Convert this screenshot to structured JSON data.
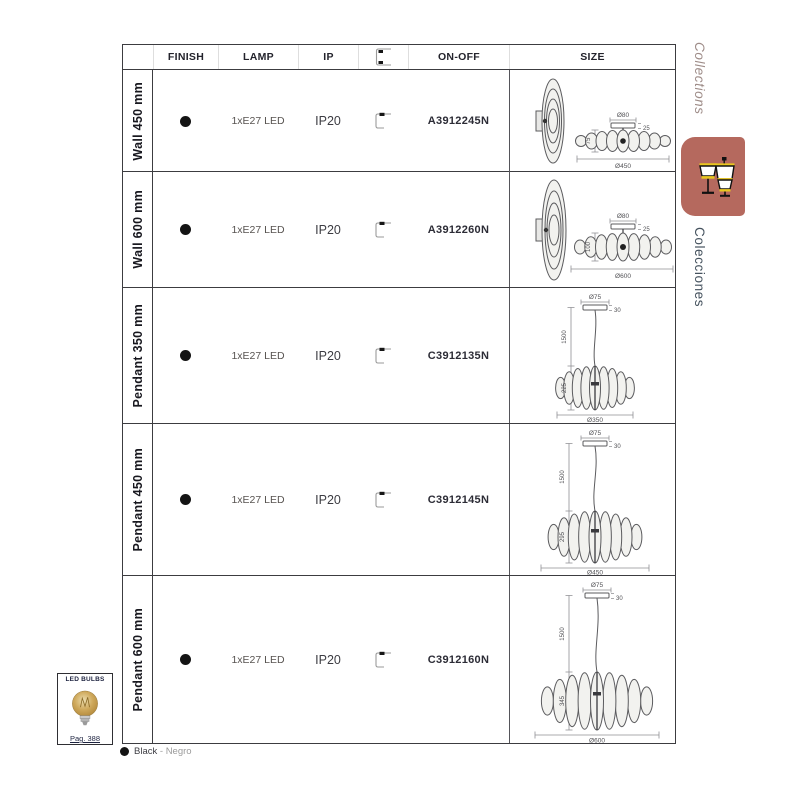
{
  "header": {
    "finish": "FINISH",
    "lamp": "LAMP",
    "ip": "IP",
    "on_off": "ON-OFF",
    "size": "SIZE"
  },
  "rows": [
    {
      "label": "Wall 450 mm",
      "lamp": "1xE27 LED",
      "ip": "IP20",
      "code": "A3912245N",
      "size": {
        "canopy_dia": "Ø80",
        "canopy_h": "25",
        "body_h": "75",
        "dia": "Ø450"
      }
    },
    {
      "label": "Wall 600 mm",
      "lamp": "1xE27 LED",
      "ip": "IP20",
      "code": "A3912260N",
      "size": {
        "canopy_dia": "Ø80",
        "canopy_h": "25",
        "body_h": "100",
        "dia": "Ø600"
      }
    },
    {
      "label": "Pendant 350 mm",
      "lamp": "1xE27 LED",
      "ip": "IP20",
      "code": "C3912135N",
      "size": {
        "canopy_dia": "Ø75",
        "canopy_h": "30",
        "drop": "1500",
        "body_h": "225",
        "dia": "Ø350"
      }
    },
    {
      "label": "Pendant 450 mm",
      "lamp": "1xE27 LED",
      "ip": "IP20",
      "code": "C3912145N",
      "size": {
        "canopy_dia": "Ø75",
        "canopy_h": "30",
        "drop": "1500",
        "body_h": "295",
        "dia": "Ø450"
      }
    },
    {
      "label": "Pendant 600 mm",
      "lamp": "1xE27 LED",
      "ip": "IP20",
      "code": "C3912160N",
      "size": {
        "canopy_dia": "Ø75",
        "canopy_h": "30",
        "drop": "1500",
        "body_h": "345",
        "dia": "Ø600"
      }
    }
  ],
  "sidebar": {
    "tab_en": "Collections",
    "tab_es": "Colecciones"
  },
  "led_bulbs": {
    "title": "LED BULBS",
    "page": "Pag. 388"
  },
  "legend": {
    "black": "Black",
    "dash": "-",
    "negro": "Negro"
  },
  "colors": {
    "accent_tab": "#b5695e",
    "icon_yellow": "#e9c71f",
    "finish_black": "#141414",
    "bulb_amber": "#c9a45a",
    "table_line": "#3c3c40"
  }
}
